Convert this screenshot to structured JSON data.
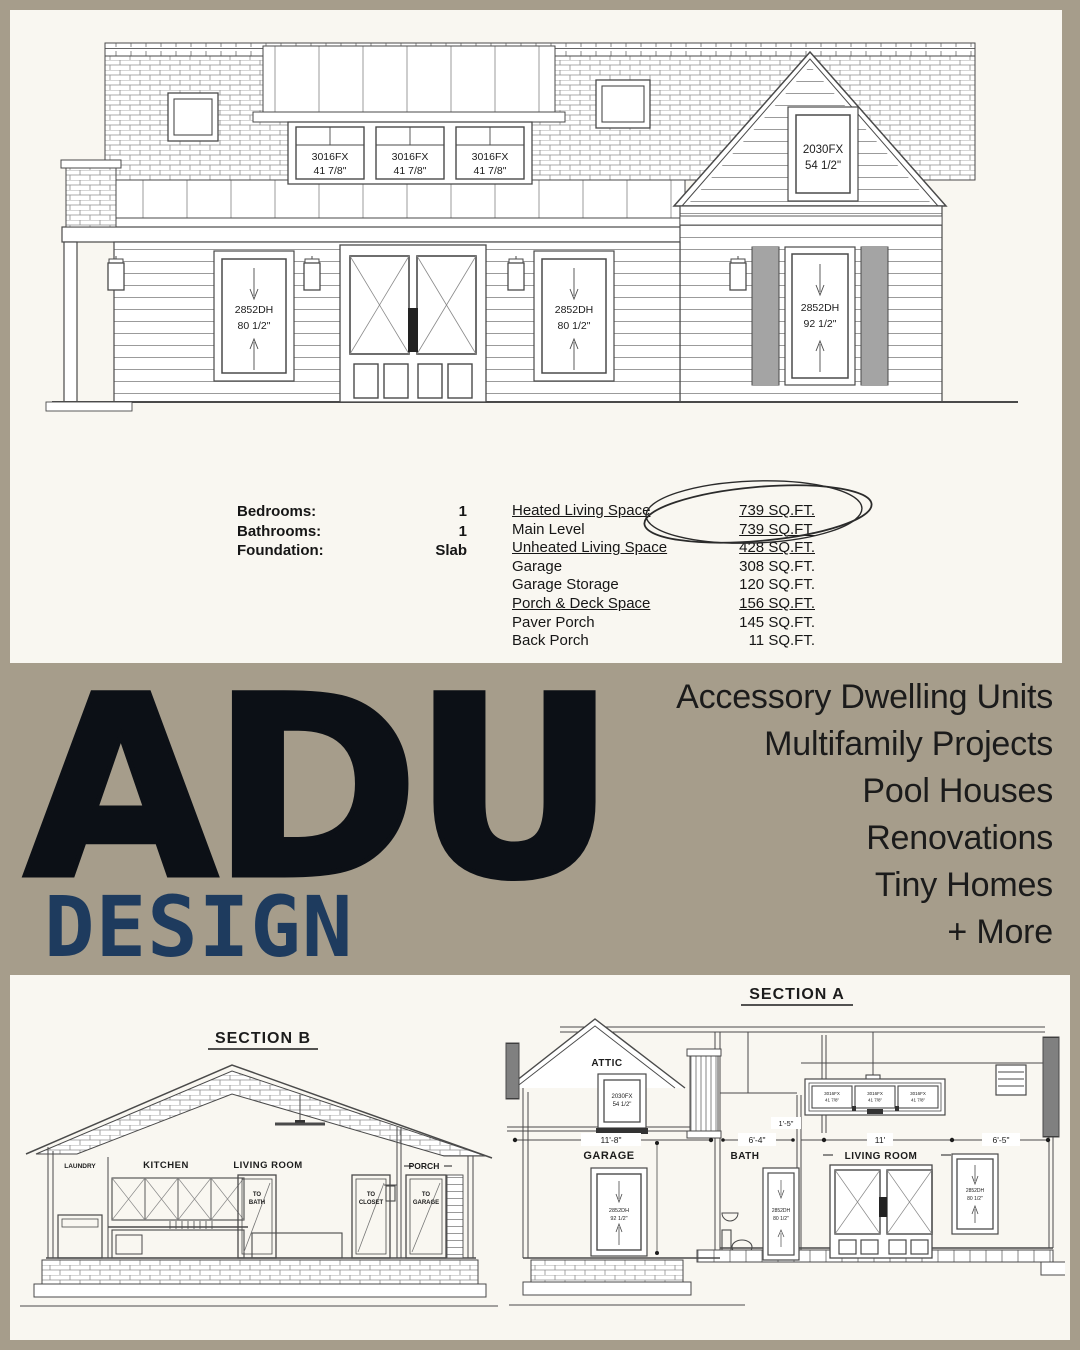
{
  "colors": {
    "band_taupe": "#a69d8b",
    "panel_cream": "#f9f7f1",
    "brand_black": "#0c1016",
    "brand_blue": "#1e3b5e",
    "line_gray": "#4a4a4a"
  },
  "top_drawing": {
    "dormer_windows": [
      {
        "model": "3016FX",
        "size": "41 7/8\""
      },
      {
        "model": "3016FX",
        "size": "41 7/8\""
      },
      {
        "model": "3016FX",
        "size": "41 7/8\""
      }
    ],
    "gable_window": {
      "model": "2030FX",
      "size": "54 1/2\""
    },
    "left_window": {
      "model": "2852DH",
      "size": "80 1/2\""
    },
    "center_window": {
      "model": "2852DH",
      "size": "80 1/2\""
    },
    "right_window": {
      "model": "2852DH",
      "size": "92 1/2\""
    }
  },
  "specs": {
    "left": [
      {
        "label": "Bedrooms:",
        "value": "1"
      },
      {
        "label": "Bathrooms:",
        "value": "1"
      },
      {
        "label": "Foundation:",
        "value": "Slab"
      }
    ],
    "right": [
      {
        "label": "Heated Living Space",
        "value": "739 SQ.FT."
      },
      {
        "label": "Main Level",
        "value": "739 SQ.FT."
      },
      {
        "label": "Unheated Living Space",
        "value": "428 SQ.FT."
      },
      {
        "label": "Garage",
        "value": "308 SQ.FT."
      },
      {
        "label": "Garage Storage",
        "value": "120 SQ.FT."
      },
      {
        "label": "Porch & Deck Space",
        "value": "156 SQ.FT."
      },
      {
        "label": "Paver Porch",
        "value": "145 SQ.FT."
      },
      {
        "label": "Back Porch",
        "value": "11 SQ.FT."
      }
    ]
  },
  "brand": {
    "name": "ADU",
    "tagline": "DESIGN"
  },
  "services": {
    "items": [
      "Accessory Dwelling Units",
      "Multifamily Projects",
      "Pool Houses",
      "Renovations",
      "Tiny Homes",
      "+ More"
    ]
  },
  "section_b": {
    "title": "SECTION B",
    "labels": {
      "laundry": "LAUNDRY",
      "kitchen": "KITCHEN",
      "living_room": "LIVING ROOM",
      "porch": "PORCH"
    },
    "doors": {
      "bath": {
        "line1": "TO",
        "line2": "BATH"
      },
      "closet": {
        "line1": "TO",
        "line2": "CLOSET"
      },
      "garage": {
        "line1": "TO",
        "line2": "GARAGE"
      }
    }
  },
  "section_a": {
    "title": "SECTION A",
    "labels": {
      "attic": "ATTIC",
      "garage": "GARAGE",
      "bath": "BATH",
      "living_room": "LIVING ROOM"
    },
    "windows": {
      "attic": {
        "model": "2030FX",
        "size": "54 1/2\""
      },
      "garage": {
        "model": "2852DH",
        "size": "92 1/2\""
      },
      "bath": {
        "model": "2852DH",
        "size": "80 1/2\""
      },
      "living": {
        "model": "2852DH",
        "size": "80 1/2\""
      },
      "transoms": [
        {
          "model": "3016FX",
          "size": "41 7/8\""
        },
        {
          "model": "3016FX",
          "size": "41 7/8\""
        },
        {
          "model": "3016FX",
          "size": "41 7/8\""
        }
      ]
    },
    "dims": {
      "garage_width": "11'-8\"",
      "bath_width": "6'-4\"",
      "offset": "1'-5\"",
      "living_width": "11'",
      "porch_width": "6'-5\""
    }
  }
}
